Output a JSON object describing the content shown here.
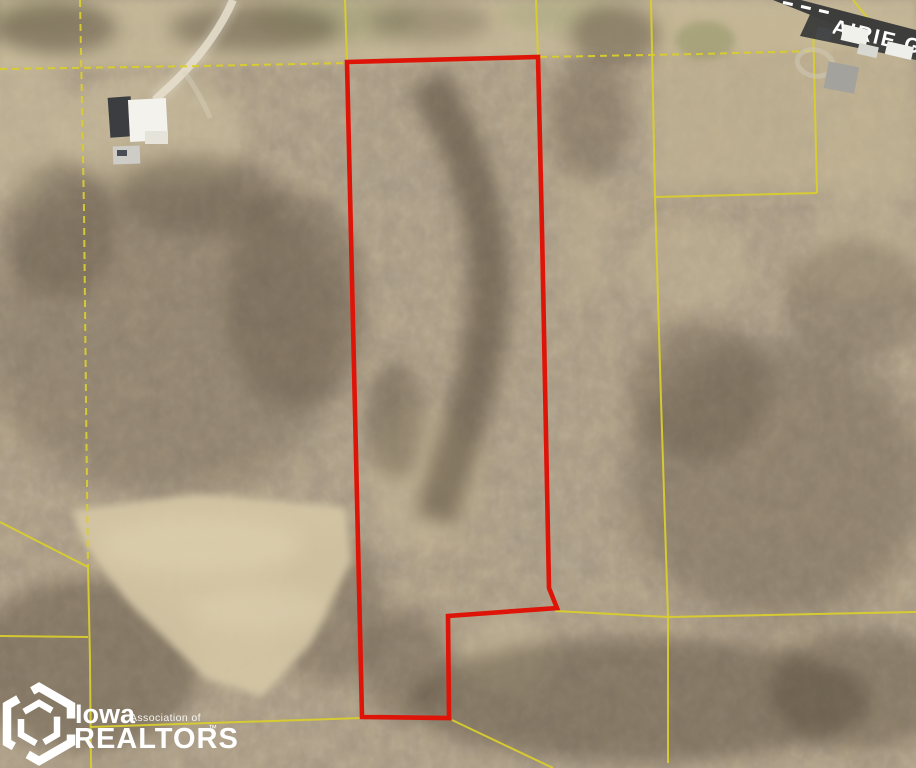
{
  "map": {
    "road": {
      "label": "AIRIE GROVE"
    },
    "watermark": {
      "iowa": "Iowa",
      "association": "Association of",
      "realtors": "REALTORS",
      "tm": "™"
    },
    "colors": {
      "boundary": "#df1408",
      "parcel": "#d9cd2e",
      "road": "#3d3e3c",
      "road_text": "#ffffff",
      "watermark": "#ffffff"
    },
    "boundary": {
      "points": "347,62 538,57 542,230 549,588 557,608 448,616 449,718 362,717"
    },
    "parcel_lines": [
      {
        "points": "0,69 200,66 347,63"
      },
      {
        "points": "540,57 700,54 811,51"
      },
      {
        "points": "80,0 84,210 86,400 88,567"
      },
      {
        "points": "0,522 88,567"
      },
      {
        "points": "88,567 90,660 91,768"
      },
      {
        "points": "0,636 88,637"
      },
      {
        "points": "90,727 362,718"
      },
      {
        "points": "452,720 553,768"
      },
      {
        "points": "345,0 347,62"
      },
      {
        "points": "536,0 538,57"
      },
      {
        "points": "651,0 655,197 661,400 668,617 668,763"
      },
      {
        "points": "655,197 817,193"
      },
      {
        "points": "813,23 817,193"
      },
      {
        "points": "555,611 668,617 916,612"
      },
      {
        "points": "853,0 871,22"
      }
    ],
    "structures": [
      {
        "x": "816",
        "y": "28",
        "width": "16",
        "height": "12",
        "fill": "#454648",
        "transform": "rotate(13 824 34)"
      },
      {
        "x": "842",
        "y": "27",
        "width": "26",
        "height": "16",
        "fill": "#f1f1ec",
        "transform": "rotate(13 855 35)"
      },
      {
        "x": "858",
        "y": "45",
        "width": "20",
        "height": "11",
        "fill": "#d8d8d2",
        "transform": "rotate(13 868 50)"
      },
      {
        "x": "826",
        "y": "64",
        "width": "31",
        "height": "27",
        "fill": "#a3a29d",
        "transform": "rotate(11 841 77)"
      },
      {
        "x": "886",
        "y": "44",
        "width": "27",
        "height": "13",
        "fill": "#eeeeea",
        "transform": "rotate(13 899 50)"
      },
      {
        "x": "109",
        "y": "97",
        "width": "23",
        "height": "40",
        "fill": "#3c3d40",
        "transform": "rotate(-4 120 117)"
      },
      {
        "x": "129",
        "y": "99",
        "width": "38",
        "height": "42",
        "fill": "#f3f2ec",
        "transform": "rotate(-3 148 120)"
      },
      {
        "x": "145",
        "y": "131",
        "width": "23",
        "height": "13",
        "fill": "#e6e4da",
        "transform": "rotate(0 0 0)"
      },
      {
        "x": "113",
        "y": "146",
        "width": "27",
        "height": "18",
        "fill": "#cdccc6",
        "transform": "rotate(-2 126 155)"
      },
      {
        "x": "117",
        "y": "150",
        "width": "10",
        "height": "6",
        "fill": "#4a4e54",
        "transform": "rotate(0 0 0)"
      }
    ]
  }
}
